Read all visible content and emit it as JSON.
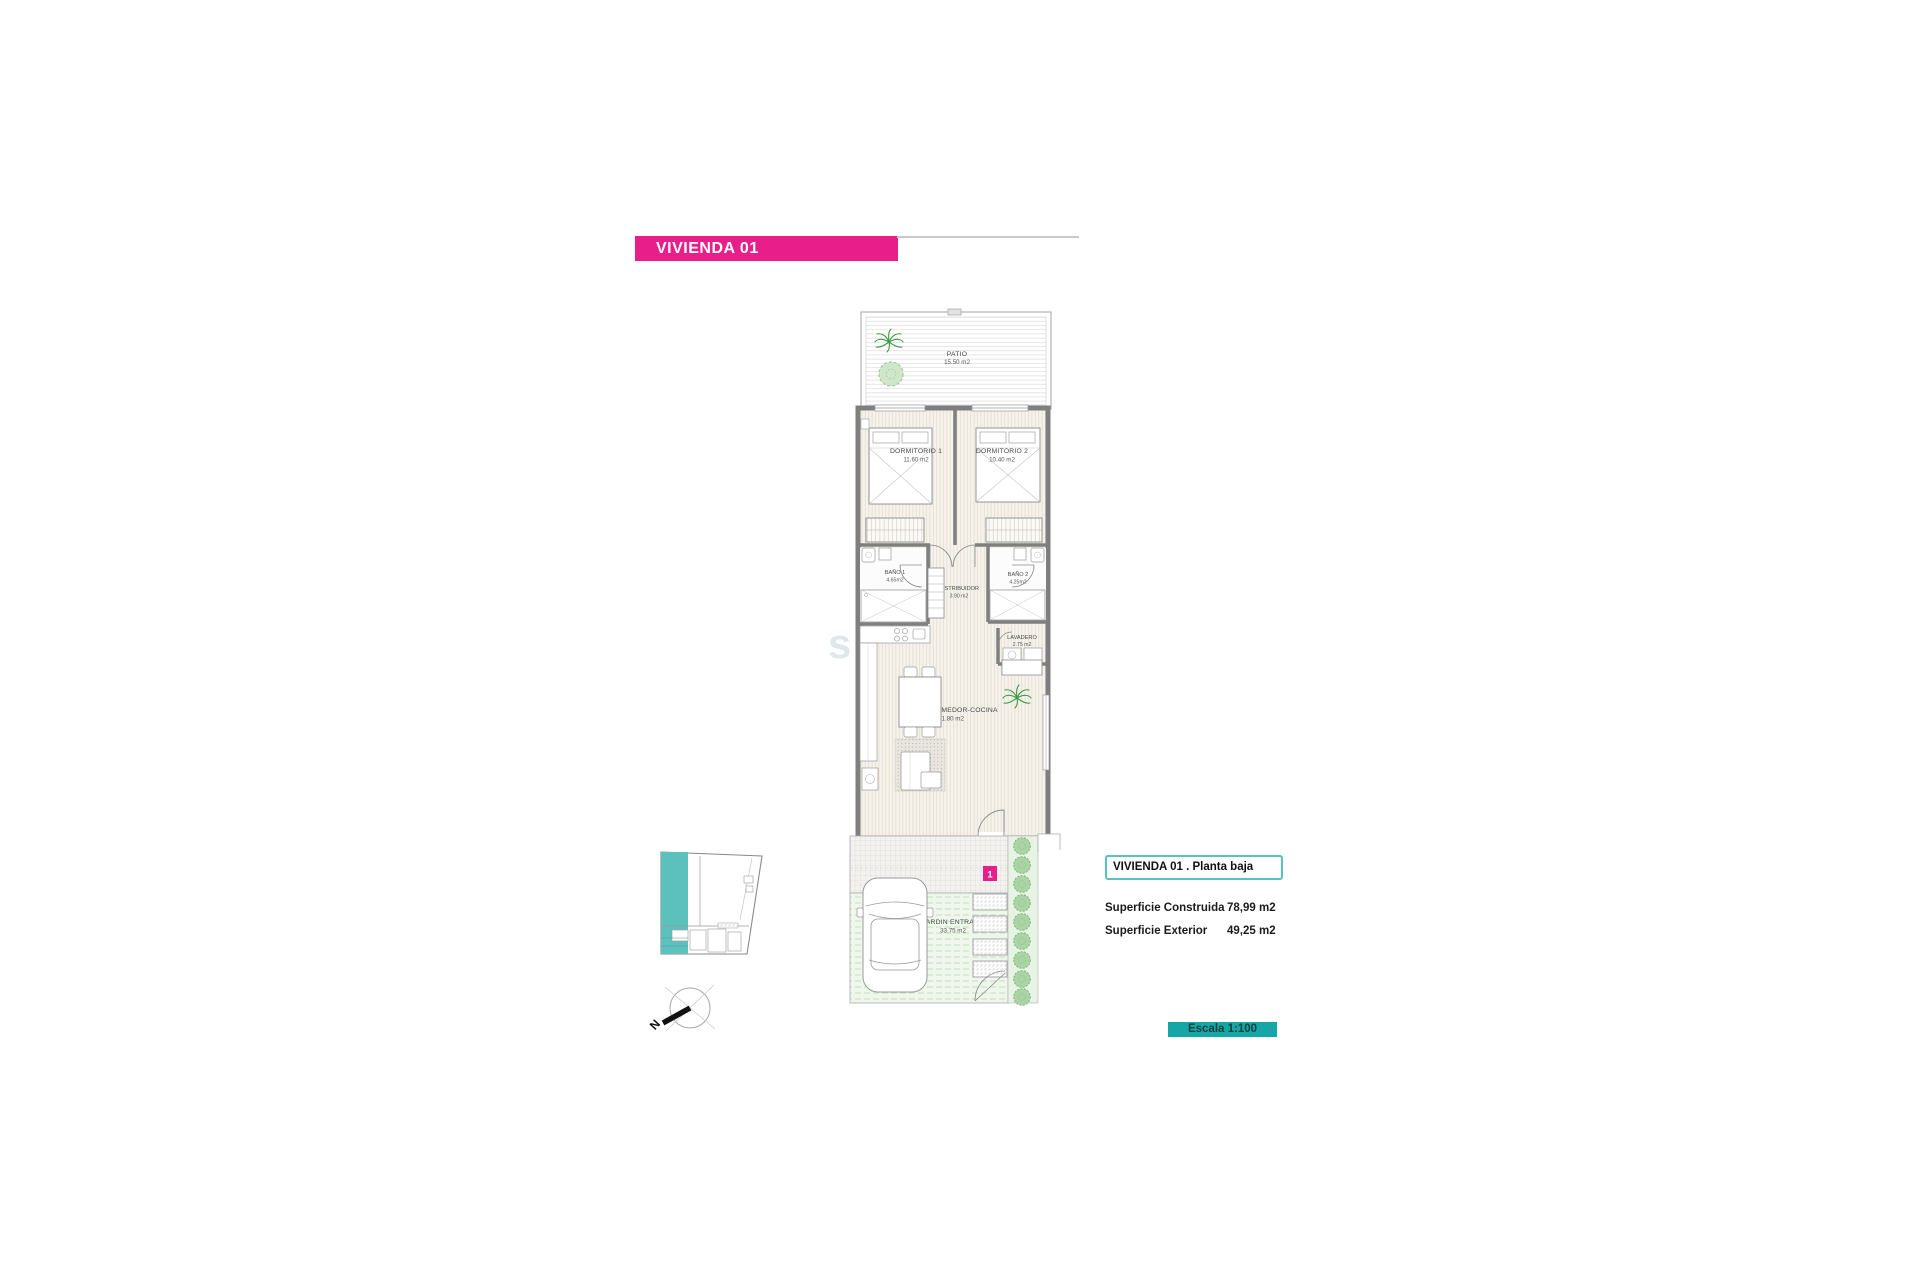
{
  "title_bar": {
    "label": "VIVIENDA 01"
  },
  "plan": {
    "rooms": [
      {
        "name": "PATIO",
        "area": "15.50 m2"
      },
      {
        "name": "DORMITORIO 1",
        "area": "11.60 m2"
      },
      {
        "name": "DORMITORIO 2",
        "area": "10.40 m2"
      },
      {
        "name": "BAÑO 1",
        "area": "4.65m2"
      },
      {
        "name": "DISTRIBUIDOR",
        "area": "3.90 m2"
      },
      {
        "name": "BAÑO 2",
        "area": "4.25m2"
      },
      {
        "name": "LAVADERO",
        "area": "2.75 m2"
      },
      {
        "name": "SALÓN-COMEDOR-COCINA",
        "area": "31.80 m2"
      },
      {
        "name": "JARDIN ENTRADA",
        "area": "33.75 m2"
      }
    ],
    "unit_marker": "1"
  },
  "info_panel": {
    "title": "VIVIENDA 01 .  Planta baja",
    "rows": [
      {
        "label": "Superficie Construida",
        "value": "78,99 m2"
      },
      {
        "label": "Superficie Exterior",
        "value": "49,25 m2"
      }
    ]
  },
  "scale_box": {
    "label": "Escala 1:100"
  },
  "compass": {
    "north_label": "N"
  },
  "watermark": {
    "text": "sde o"
  },
  "colors": {
    "accent_pink": "#E81F8A",
    "scale_teal": "#17A6A6",
    "keyplan_teal": "#5CC0BD",
    "info_border_teal": "#58C1C1",
    "plant_green": "#7CB878",
    "wall_gray": "#7F7F7F"
  }
}
